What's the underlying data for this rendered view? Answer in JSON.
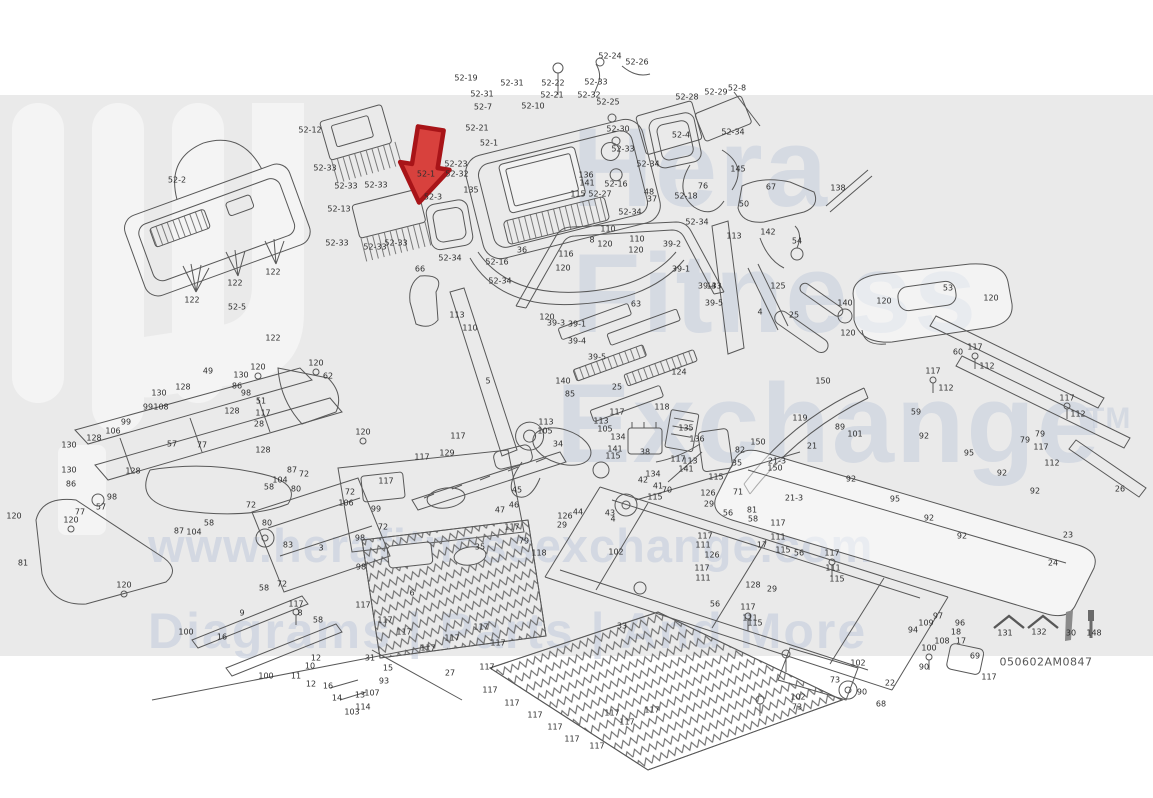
{
  "watermark": {
    "word1": "Hera",
    "word2": "Fitness",
    "word3": "Exchange",
    "tm": "TM",
    "url_line": "www.herafitnessexchange.com",
    "tagline_line": "Diagrams | Parts | And More",
    "text_color": "#c2cbdc",
    "band_color": "#eaeaea"
  },
  "diagram": {
    "drawing_code": "050602AM0847",
    "highlighted_part": "52-3",
    "arrow_color": "#d8413d",
    "labels": [
      [
        "52-19",
        466,
        78
      ],
      [
        "52-31",
        512,
        83
      ],
      [
        "52-31",
        482,
        94
      ],
      [
        "52-22",
        553,
        83
      ],
      [
        "52-33",
        596,
        82
      ],
      [
        "52-24",
        610,
        56
      ],
      [
        "52-26",
        637,
        62
      ],
      [
        "52-21",
        552,
        95
      ],
      [
        "52-32",
        589,
        95
      ],
      [
        "52-7",
        483,
        107
      ],
      [
        "52-10",
        533,
        106
      ],
      [
        "52-25",
        608,
        102
      ],
      [
        "52-28",
        687,
        97
      ],
      [
        "52-29",
        716,
        92
      ],
      [
        "52-8",
        737,
        88
      ],
      [
        "52-21",
        477,
        128
      ],
      [
        "52-30",
        618,
        129
      ],
      [
        "52-4",
        681,
        135
      ],
      [
        "52-34",
        733,
        132
      ],
      [
        "52-1",
        489,
        143
      ],
      [
        "52-33",
        623,
        149
      ],
      [
        "52-23",
        456,
        164
      ],
      [
        "52-32",
        457,
        174
      ],
      [
        "52-34",
        648,
        164
      ],
      [
        "135",
        471,
        190
      ],
      [
        "136",
        586,
        175
      ],
      [
        "141",
        587,
        183
      ],
      [
        "115",
        578,
        194
      ],
      [
        "52-27",
        600,
        194
      ],
      [
        "52-16",
        616,
        184
      ],
      [
        "48",
        649,
        192
      ],
      [
        "37",
        652,
        199
      ],
      [
        "145",
        738,
        169
      ],
      [
        "76",
        703,
        186
      ],
      [
        "52-18",
        686,
        196
      ],
      [
        "52-34",
        630,
        212
      ],
      [
        "52-34",
        697,
        222
      ],
      [
        "52-16",
        497,
        262
      ],
      [
        "52-34",
        500,
        281
      ],
      [
        "36",
        522,
        250
      ],
      [
        "52-12",
        310,
        130
      ],
      [
        "52-2",
        177,
        180
      ],
      [
        "52-33",
        325,
        168
      ],
      [
        "52-33",
        346,
        186
      ],
      [
        "52-33",
        376,
        185
      ],
      [
        "52-13",
        339,
        209
      ],
      [
        "52-33",
        337,
        243
      ],
      [
        "52-33",
        375,
        247
      ],
      [
        "52-33",
        396,
        243
      ],
      [
        "52-1",
        426,
        174
      ],
      [
        "52-3",
        433,
        197
      ],
      [
        "52-34",
        450,
        258
      ],
      [
        "66",
        420,
        269
      ],
      [
        "122",
        192,
        300
      ],
      [
        "122",
        235,
        283
      ],
      [
        "122",
        273,
        272
      ],
      [
        "52-5",
        237,
        307
      ],
      [
        "122",
        273,
        338
      ],
      [
        "113",
        457,
        315
      ],
      [
        "110",
        470,
        328
      ],
      [
        "5",
        488,
        381
      ],
      [
        "8",
        592,
        240
      ],
      [
        "110",
        608,
        229
      ],
      [
        "120",
        605,
        244
      ],
      [
        "110",
        637,
        239
      ],
      [
        "120",
        636,
        250
      ],
      [
        "116",
        566,
        254
      ],
      [
        "120",
        563,
        268
      ],
      [
        "39-2",
        672,
        244
      ],
      [
        "39-1",
        681,
        269
      ],
      [
        "120",
        547,
        317
      ],
      [
        "39-3",
        556,
        323
      ],
      [
        "39-1",
        577,
        324
      ],
      [
        "39-4",
        707,
        286
      ],
      [
        "39-5",
        714,
        303
      ],
      [
        "63",
        636,
        304
      ],
      [
        "39-4",
        577,
        341
      ],
      [
        "39-5",
        597,
        357
      ],
      [
        "124",
        679,
        372
      ],
      [
        "4",
        760,
        312
      ],
      [
        "67",
        771,
        187
      ],
      [
        "138",
        838,
        188
      ],
      [
        "50",
        744,
        204
      ],
      [
        "113",
        734,
        236
      ],
      [
        "142",
        768,
        232
      ],
      [
        "54",
        797,
        241
      ],
      [
        "133",
        714,
        286
      ],
      [
        "125",
        778,
        286
      ],
      [
        "140",
        845,
        303
      ],
      [
        "25",
        794,
        315
      ],
      [
        "120",
        884,
        301
      ],
      [
        "53",
        948,
        288
      ],
      [
        "120",
        991,
        298
      ],
      [
        "120",
        848,
        333
      ],
      [
        "150",
        823,
        381
      ],
      [
        "119",
        800,
        418
      ],
      [
        "150",
        758,
        442
      ],
      [
        "150",
        775,
        468
      ],
      [
        "60",
        958,
        352
      ],
      [
        "117",
        975,
        347
      ],
      [
        "112",
        987,
        366
      ],
      [
        "117",
        933,
        371
      ],
      [
        "112",
        946,
        388
      ],
      [
        "117",
        1067,
        398
      ],
      [
        "112",
        1078,
        414
      ],
      [
        "79",
        1025,
        440
      ],
      [
        "79",
        1040,
        434
      ],
      [
        "117",
        1041,
        447
      ],
      [
        "112",
        1052,
        463
      ],
      [
        "26",
        1120,
        489
      ],
      [
        "59",
        916,
        412
      ],
      [
        "140",
        563,
        381
      ],
      [
        "25",
        617,
        387
      ],
      [
        "85",
        570,
        394
      ],
      [
        "113",
        546,
        422
      ],
      [
        "113",
        601,
        421
      ],
      [
        "105",
        545,
        431
      ],
      [
        "105",
        605,
        429
      ],
      [
        "134",
        618,
        437
      ],
      [
        "141",
        615,
        449
      ],
      [
        "115",
        613,
        456
      ],
      [
        "34",
        558,
        444
      ],
      [
        "117",
        617,
        412
      ],
      [
        "118",
        662,
        407
      ],
      [
        "38",
        645,
        452
      ],
      [
        "135",
        686,
        428
      ],
      [
        "136",
        697,
        439
      ],
      [
        "117",
        678,
        459
      ],
      [
        "82",
        740,
        450
      ],
      [
        "35",
        737,
        463
      ],
      [
        "113",
        690,
        461
      ],
      [
        "141",
        686,
        469
      ],
      [
        "115",
        716,
        477
      ],
      [
        "71",
        738,
        492
      ],
      [
        "70",
        667,
        490
      ],
      [
        "134",
        653,
        474
      ],
      [
        "42",
        643,
        480
      ],
      [
        "41",
        658,
        486
      ],
      [
        "115",
        655,
        497
      ],
      [
        "21",
        812,
        446
      ],
      [
        "21-3",
        777,
        461
      ],
      [
        "21-3",
        794,
        498
      ],
      [
        "89",
        840,
        427
      ],
      [
        "101",
        855,
        434
      ],
      [
        "44",
        578,
        512
      ],
      [
        "43",
        610,
        513
      ],
      [
        "126",
        565,
        516
      ],
      [
        "29",
        562,
        525
      ],
      [
        "4",
        613,
        519
      ],
      [
        "118",
        539,
        553
      ],
      [
        "102",
        616,
        552
      ],
      [
        "126",
        708,
        493
      ],
      [
        "29",
        709,
        504
      ],
      [
        "56",
        728,
        513
      ],
      [
        "81",
        752,
        510
      ],
      [
        "58",
        753,
        519
      ],
      [
        "117",
        778,
        523
      ],
      [
        "111",
        778,
        537
      ],
      [
        "115",
        783,
        550
      ],
      [
        "117",
        705,
        536
      ],
      [
        "111",
        703,
        545
      ],
      [
        "126",
        712,
        555
      ],
      [
        "117",
        702,
        568
      ],
      [
        "111",
        703,
        578
      ],
      [
        "56",
        799,
        553
      ],
      [
        "117",
        832,
        553
      ],
      [
        "111",
        833,
        568
      ],
      [
        "115",
        837,
        579
      ],
      [
        "128",
        753,
        585
      ],
      [
        "29",
        772,
        589
      ],
      [
        "56",
        715,
        604
      ],
      [
        "117",
        748,
        607
      ],
      [
        "111",
        750,
        618
      ],
      [
        "115",
        755,
        623
      ],
      [
        "17",
        762,
        545
      ],
      [
        "95",
        895,
        499
      ],
      [
        "92",
        924,
        436
      ],
      [
        "95",
        969,
        453
      ],
      [
        "92",
        1002,
        473
      ],
      [
        "92",
        851,
        479
      ],
      [
        "92",
        1035,
        491
      ],
      [
        "92",
        929,
        518
      ],
      [
        "92",
        962,
        536
      ],
      [
        "23",
        1068,
        535
      ],
      [
        "24",
        1053,
        563
      ],
      [
        "97",
        938,
        616
      ],
      [
        "109",
        926,
        623
      ],
      [
        "96",
        960,
        623
      ],
      [
        "94",
        913,
        630
      ],
      [
        "18",
        956,
        632
      ],
      [
        "17",
        961,
        641
      ],
      [
        "108",
        942,
        641
      ],
      [
        "100",
        929,
        648
      ],
      [
        "90",
        924,
        667
      ],
      [
        "69",
        975,
        656
      ],
      [
        "117",
        989,
        677
      ],
      [
        "90",
        862,
        692
      ],
      [
        "22",
        890,
        683
      ],
      [
        "68",
        881,
        704
      ],
      [
        "102",
        858,
        663
      ],
      [
        "73",
        835,
        680
      ],
      [
        "102",
        798,
        697
      ],
      [
        "73",
        797,
        707
      ],
      [
        "131",
        1005,
        633
      ],
      [
        "132",
        1039,
        632
      ],
      [
        "30",
        1071,
        633
      ],
      [
        "148",
        1094,
        633
      ],
      [
        "49",
        208,
        371
      ],
      [
        "130",
        241,
        375
      ],
      [
        "128",
        183,
        387
      ],
      [
        "130",
        159,
        393
      ],
      [
        "86",
        237,
        386
      ],
      [
        "98",
        246,
        393
      ],
      [
        "51",
        261,
        401
      ],
      [
        "128",
        232,
        411
      ],
      [
        "117",
        263,
        413
      ],
      [
        "28",
        259,
        424
      ],
      [
        "99",
        148,
        407
      ],
      [
        "108",
        161,
        407
      ],
      [
        "99",
        126,
        422
      ],
      [
        "106",
        113,
        431
      ],
      [
        "128",
        94,
        438
      ],
      [
        "130",
        69,
        445
      ],
      [
        "130",
        69,
        470
      ],
      [
        "86",
        71,
        484
      ],
      [
        "120",
        258,
        367
      ],
      [
        "120",
        316,
        363
      ],
      [
        "62",
        328,
        376
      ],
      [
        "120",
        363,
        432
      ],
      [
        "57",
        172,
        444
      ],
      [
        "77",
        202,
        445
      ],
      [
        "128",
        133,
        471
      ],
      [
        "128",
        263,
        450
      ],
      [
        "98",
        112,
        497
      ],
      [
        "57",
        101,
        507
      ],
      [
        "77",
        80,
        512
      ],
      [
        "120",
        71,
        520
      ],
      [
        "58",
        209,
        523
      ],
      [
        "87",
        179,
        531
      ],
      [
        "104",
        194,
        532
      ],
      [
        "81",
        23,
        563
      ],
      [
        "120",
        14,
        516
      ],
      [
        "120",
        124,
        585
      ],
      [
        "72",
        251,
        505
      ],
      [
        "87",
        292,
        470
      ],
      [
        "104",
        280,
        480
      ],
      [
        "58",
        269,
        487
      ],
      [
        "80",
        296,
        489
      ],
      [
        "80",
        267,
        523
      ],
      [
        "83",
        288,
        545
      ],
      [
        "3",
        321,
        548
      ],
      [
        "98",
        360,
        538
      ],
      [
        "98",
        361,
        567
      ],
      [
        "106",
        346,
        503
      ],
      [
        "99",
        376,
        509
      ],
      [
        "72",
        304,
        474
      ],
      [
        "72",
        350,
        492
      ],
      [
        "72",
        383,
        527
      ],
      [
        "72",
        282,
        584
      ],
      [
        "58",
        264,
        588
      ],
      [
        "100",
        186,
        632
      ],
      [
        "9",
        242,
        613
      ],
      [
        "8",
        300,
        613
      ],
      [
        "16",
        222,
        637
      ],
      [
        "117",
        296,
        604
      ],
      [
        "58",
        318,
        620
      ],
      [
        "100",
        266,
        676
      ],
      [
        "12",
        316,
        658
      ],
      [
        "10",
        310,
        666
      ],
      [
        "11",
        296,
        676
      ],
      [
        "12",
        311,
        684
      ],
      [
        "16",
        328,
        686
      ],
      [
        "14",
        337,
        698
      ],
      [
        "13",
        360,
        695
      ],
      [
        "107",
        372,
        693
      ],
      [
        "114",
        363,
        707
      ],
      [
        "103",
        352,
        712
      ],
      [
        "31",
        370,
        658
      ],
      [
        "15",
        388,
        668
      ],
      [
        "93",
        384,
        681
      ],
      [
        "27",
        450,
        673
      ],
      [
        "129",
        447,
        453
      ],
      [
        "117",
        458,
        436
      ],
      [
        "117",
        422,
        457
      ],
      [
        "117",
        386,
        481
      ],
      [
        "45",
        517,
        490
      ],
      [
        "46",
        514,
        505
      ],
      [
        "47",
        500,
        510
      ],
      [
        "117",
        512,
        527
      ],
      [
        "79",
        524,
        541
      ],
      [
        "35",
        480,
        547
      ],
      [
        "6",
        412,
        593
      ],
      [
        "33",
        622,
        626
      ],
      [
        "117",
        363,
        605
      ],
      [
        "117",
        385,
        620
      ],
      [
        "117",
        404,
        632
      ],
      [
        "117",
        428,
        648
      ],
      [
        "117",
        452,
        638
      ],
      [
        "117",
        481,
        627
      ],
      [
        "117",
        498,
        643
      ],
      [
        "117",
        487,
        667
      ],
      [
        "117",
        490,
        690
      ],
      [
        "117",
        512,
        703
      ],
      [
        "117",
        535,
        715
      ],
      [
        "117",
        555,
        727
      ],
      [
        "117",
        572,
        739
      ],
      [
        "117",
        597,
        746
      ],
      [
        "117",
        612,
        713
      ],
      [
        "117",
        627,
        722
      ],
      [
        "117",
        652,
        710
      ]
    ]
  }
}
